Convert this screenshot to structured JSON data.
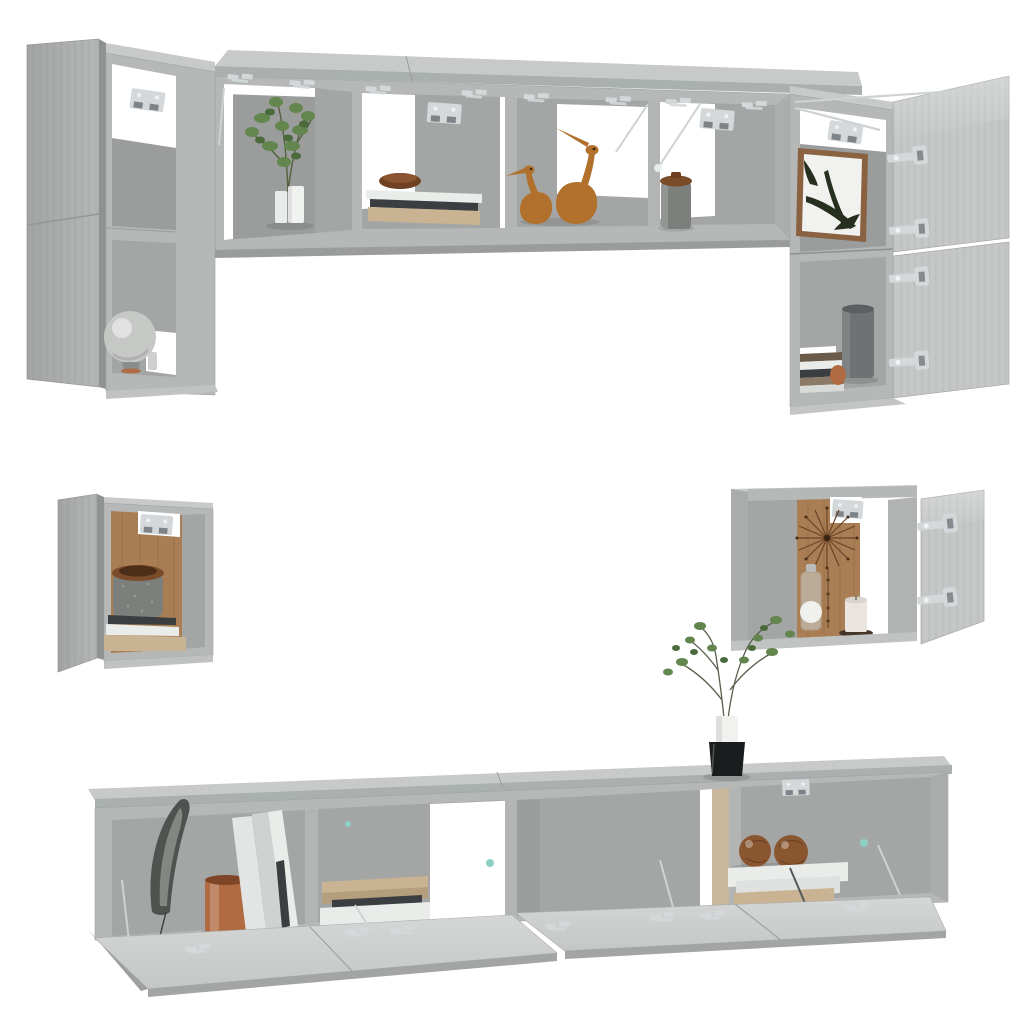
{
  "scene": {
    "description": "Product photo of a 6-piece wall-mounted TV cabinet set in concrete grey, shown floating on a white background with doors and flaps open",
    "background": "#ffffff"
  },
  "palette": {
    "concrete": "#b5b8b6",
    "concrete_top": "#c7cac8",
    "door": "#b3b6b4",
    "door_edge": "#8f9290",
    "flap": "#c4c7c5",
    "flap_edge": "#a2a5a3",
    "interior": "#a3a6a4",
    "interior_dark": "#9a9d9b",
    "back_brown": "#a97e54",
    "tan_strip": "#c8b69d",
    "metal": "#d4d8da",
    "plant_green": "#63854e",
    "plant_green_dark": "#4a6a3c",
    "duck_wood": "#b2702d",
    "copper": "#b06b42",
    "wood_ball": "#8a5630",
    "book_white": "#eaecea",
    "book_dark": "#3b3e40",
    "book_beige": "#c9b392",
    "granite": "#7d7f7d",
    "wood_lid": "#7b4c2a",
    "canvas": "#f1f2ef",
    "leaf_art": "#27301f",
    "frame_wood": "#8a6242",
    "vase_black": "#1a1c1d",
    "candle": "#eae6df",
    "sphere_lamp": "#c6c8c6",
    "grey_vase": "#6f7274",
    "catch_teal": "#8fd0c6",
    "feather": "#4f524f",
    "white_gap": "#ffffff"
  },
  "units": [
    {
      "name": "left-stacked-wall-cabinets",
      "count": 2,
      "doors": "open to the left",
      "contents": [
        "sphere lamp on small stand"
      ]
    },
    {
      "name": "top-horizontal-wall-cabinets",
      "count": 2,
      "doors": "lift-up flaps open",
      "compartments": [
        "green plant in white pots",
        "stacked books with wooden bowl",
        "two wooden duck figurines",
        "stone storage jar with wooden lid"
      ]
    },
    {
      "name": "right-stacked-wall-cabinets",
      "count": 2,
      "doors": "open to the right",
      "contents": [
        "framed botanical leaf print",
        "dark grey vase, copper jar and striped books"
      ]
    },
    {
      "name": "left-small-wall-cabinet",
      "count": 1,
      "doors": "open to the left",
      "contents": [
        "granite pot with wooden lid",
        "stacked books on beige board"
      ]
    },
    {
      "name": "right-small-wall-cabinet",
      "count": 1,
      "doors": "open to the right",
      "contents": [
        "wooden sunburst clock",
        "glass jar",
        "pillar candle on dark tray"
      ]
    },
    {
      "name": "bottom-tv-wall-cabinets",
      "count": 2,
      "doors": "drop-down flaps open",
      "compartments": [
        "feather print, copper pot, leaning folders",
        "stacked books",
        "empty",
        "two wooden spheres on white books"
      ],
      "decor": [
        "delicate plant in black cube vase standing on top"
      ]
    }
  ]
}
